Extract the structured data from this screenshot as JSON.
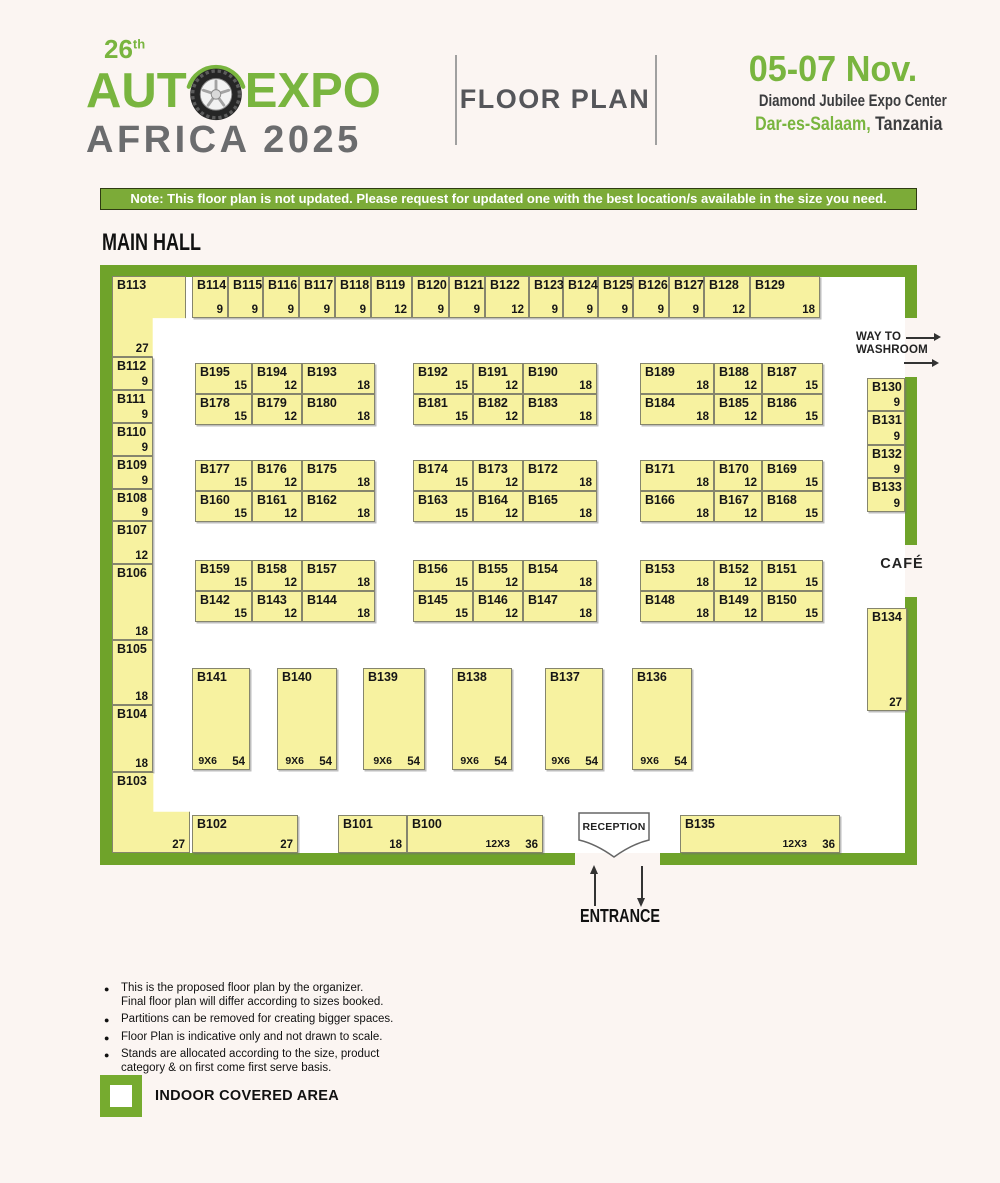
{
  "logo": {
    "edition": "26",
    "edition_sup": "th",
    "word1": "AUT",
    "word2": "EXPO",
    "line2": "AFRICA 2025"
  },
  "header": {
    "title": "FLOOR PLAN",
    "dates": "05-07 Nov.",
    "venue": "Diamond Jubilee Expo Center",
    "city": "Dar-es-Salaam,",
    "country": "Tanzania"
  },
  "note": "Note: This floor plan is not updated. Please request for updated one with the best location/s available in the size you need.",
  "hall_title": "MAIN HALL",
  "labels": {
    "way_to": "WAY TO",
    "washroom": "WASHROOM",
    "cafe": "CAFÉ",
    "reception": "RECEPTION",
    "entrance": "ENTRANCE"
  },
  "colors": {
    "brand_green": "#79b53f",
    "wall_green": "#6fa32a",
    "note_bar_green": "#7cab38",
    "booth_fill": "#f7f2a0",
    "title_gray": "#55565a"
  },
  "booths": [
    {
      "id": "B113",
      "size": "27",
      "x": 112,
      "y": 276,
      "w": 74,
      "h": 81,
      "shape": "corner-tl"
    },
    {
      "id": "B114",
      "size": "9",
      "x": 192,
      "y": 276,
      "w": 36,
      "h": 42
    },
    {
      "id": "B115",
      "size": "9",
      "x": 228,
      "y": 276,
      "w": 35,
      "h": 42
    },
    {
      "id": "B116",
      "size": "9",
      "x": 263,
      "y": 276,
      "w": 36,
      "h": 42
    },
    {
      "id": "B117",
      "size": "9",
      "x": 299,
      "y": 276,
      "w": 36,
      "h": 42
    },
    {
      "id": "B118",
      "size": "9",
      "x": 335,
      "y": 276,
      "w": 36,
      "h": 42
    },
    {
      "id": "B119",
      "size": "12",
      "x": 371,
      "y": 276,
      "w": 41,
      "h": 42
    },
    {
      "id": "B120",
      "size": "9",
      "x": 412,
      "y": 276,
      "w": 37,
      "h": 42
    },
    {
      "id": "B121",
      "size": "9",
      "x": 449,
      "y": 276,
      "w": 36,
      "h": 42
    },
    {
      "id": "B122",
      "size": "12",
      "x": 485,
      "y": 276,
      "w": 44,
      "h": 42
    },
    {
      "id": "B123",
      "size": "9",
      "x": 529,
      "y": 276,
      "w": 34,
      "h": 42
    },
    {
      "id": "B124",
      "size": "9",
      "x": 563,
      "y": 276,
      "w": 35,
      "h": 42
    },
    {
      "id": "B125",
      "size": "9",
      "x": 598,
      "y": 276,
      "w": 35,
      "h": 42
    },
    {
      "id": "B126",
      "size": "9",
      "x": 633,
      "y": 276,
      "w": 36,
      "h": 42
    },
    {
      "id": "B127",
      "size": "9",
      "x": 669,
      "y": 276,
      "w": 35,
      "h": 42
    },
    {
      "id": "B128",
      "size": "12",
      "x": 704,
      "y": 276,
      "w": 46,
      "h": 42
    },
    {
      "id": "B129",
      "size": "18",
      "x": 750,
      "y": 276,
      "w": 70,
      "h": 42
    },
    {
      "id": "B112",
      "size": "9",
      "x": 112,
      "y": 357,
      "w": 41,
      "h": 33
    },
    {
      "id": "B111",
      "size": "9",
      "x": 112,
      "y": 390,
      "w": 41,
      "h": 33
    },
    {
      "id": "B110",
      "size": "9",
      "x": 112,
      "y": 423,
      "w": 41,
      "h": 33
    },
    {
      "id": "B109",
      "size": "9",
      "x": 112,
      "y": 456,
      "w": 41,
      "h": 33
    },
    {
      "id": "B108",
      "size": "9",
      "x": 112,
      "y": 489,
      "w": 41,
      "h": 32
    },
    {
      "id": "B107",
      "size": "12",
      "x": 112,
      "y": 521,
      "w": 41,
      "h": 43
    },
    {
      "id": "B106",
      "size": "18",
      "x": 112,
      "y": 564,
      "w": 41,
      "h": 76
    },
    {
      "id": "B105",
      "size": "18",
      "x": 112,
      "y": 640,
      "w": 41,
      "h": 65
    },
    {
      "id": "B104",
      "size": "18",
      "x": 112,
      "y": 705,
      "w": 41,
      "h": 67
    },
    {
      "id": "B103",
      "size": "27",
      "x": 112,
      "y": 772,
      "w": 78,
      "h": 81,
      "shape": "corner-bl"
    },
    {
      "id": "B130",
      "size": "9",
      "x": 867,
      "y": 378,
      "w": 38,
      "h": 33
    },
    {
      "id": "B131",
      "size": "9",
      "x": 867,
      "y": 411,
      "w": 38,
      "h": 34
    },
    {
      "id": "B132",
      "size": "9",
      "x": 867,
      "y": 445,
      "w": 38,
      "h": 33
    },
    {
      "id": "B133",
      "size": "9",
      "x": 867,
      "y": 478,
      "w": 38,
      "h": 34
    },
    {
      "id": "B134",
      "size": "27",
      "x": 867,
      "y": 608,
      "w": 40,
      "h": 103
    },
    {
      "id": "B195",
      "size": "15",
      "x": 195,
      "y": 363,
      "w": 57,
      "h": 31
    },
    {
      "id": "B194",
      "size": "12",
      "x": 252,
      "y": 363,
      "w": 50,
      "h": 31
    },
    {
      "id": "B193",
      "size": "18",
      "x": 302,
      "y": 363,
      "w": 73,
      "h": 31
    },
    {
      "id": "B178",
      "size": "15",
      "x": 195,
      "y": 394,
      "w": 57,
      "h": 31
    },
    {
      "id": "B179",
      "size": "12",
      "x": 252,
      "y": 394,
      "w": 50,
      "h": 31
    },
    {
      "id": "B180",
      "size": "18",
      "x": 302,
      "y": 394,
      "w": 73,
      "h": 31
    },
    {
      "id": "B192",
      "size": "15",
      "x": 413,
      "y": 363,
      "w": 60,
      "h": 31
    },
    {
      "id": "B191",
      "size": "12",
      "x": 473,
      "y": 363,
      "w": 50,
      "h": 31
    },
    {
      "id": "B190",
      "size": "18",
      "x": 523,
      "y": 363,
      "w": 74,
      "h": 31
    },
    {
      "id": "B181",
      "size": "15",
      "x": 413,
      "y": 394,
      "w": 60,
      "h": 31
    },
    {
      "id": "B182",
      "size": "12",
      "x": 473,
      "y": 394,
      "w": 50,
      "h": 31
    },
    {
      "id": "B183",
      "size": "18",
      "x": 523,
      "y": 394,
      "w": 74,
      "h": 31
    },
    {
      "id": "B189",
      "size": "18",
      "x": 640,
      "y": 363,
      "w": 74,
      "h": 31
    },
    {
      "id": "B188",
      "size": "12",
      "x": 714,
      "y": 363,
      "w": 48,
      "h": 31
    },
    {
      "id": "B187",
      "size": "15",
      "x": 762,
      "y": 363,
      "w": 61,
      "h": 31
    },
    {
      "id": "B184",
      "size": "18",
      "x": 640,
      "y": 394,
      "w": 74,
      "h": 31
    },
    {
      "id": "B185",
      "size": "12",
      "x": 714,
      "y": 394,
      "w": 48,
      "h": 31
    },
    {
      "id": "B186",
      "size": "15",
      "x": 762,
      "y": 394,
      "w": 61,
      "h": 31
    },
    {
      "id": "B177",
      "size": "15",
      "x": 195,
      "y": 460,
      "w": 57,
      "h": 31
    },
    {
      "id": "B176",
      "size": "12",
      "x": 252,
      "y": 460,
      "w": 50,
      "h": 31
    },
    {
      "id": "B175",
      "size": "18",
      "x": 302,
      "y": 460,
      "w": 73,
      "h": 31
    },
    {
      "id": "B160",
      "size": "15",
      "x": 195,
      "y": 491,
      "w": 57,
      "h": 31
    },
    {
      "id": "B161",
      "size": "12",
      "x": 252,
      "y": 491,
      "w": 50,
      "h": 31
    },
    {
      "id": "B162",
      "size": "18",
      "x": 302,
      "y": 491,
      "w": 73,
      "h": 31
    },
    {
      "id": "B174",
      "size": "15",
      "x": 413,
      "y": 460,
      "w": 60,
      "h": 31
    },
    {
      "id": "B173",
      "size": "12",
      "x": 473,
      "y": 460,
      "w": 50,
      "h": 31
    },
    {
      "id": "B172",
      "size": "18",
      "x": 523,
      "y": 460,
      "w": 74,
      "h": 31
    },
    {
      "id": "B163",
      "size": "15",
      "x": 413,
      "y": 491,
      "w": 60,
      "h": 31
    },
    {
      "id": "B164",
      "size": "12",
      "x": 473,
      "y": 491,
      "w": 50,
      "h": 31
    },
    {
      "id": "B165",
      "size": "18",
      "x": 523,
      "y": 491,
      "w": 74,
      "h": 31
    },
    {
      "id": "B171",
      "size": "18",
      "x": 640,
      "y": 460,
      "w": 74,
      "h": 31
    },
    {
      "id": "B170",
      "size": "12",
      "x": 714,
      "y": 460,
      "w": 48,
      "h": 31
    },
    {
      "id": "B169",
      "size": "15",
      "x": 762,
      "y": 460,
      "w": 61,
      "h": 31
    },
    {
      "id": "B166",
      "size": "18",
      "x": 640,
      "y": 491,
      "w": 74,
      "h": 31
    },
    {
      "id": "B167",
      "size": "12",
      "x": 714,
      "y": 491,
      "w": 48,
      "h": 31
    },
    {
      "id": "B168",
      "size": "15",
      "x": 762,
      "y": 491,
      "w": 61,
      "h": 31
    },
    {
      "id": "B159",
      "size": "15",
      "x": 195,
      "y": 560,
      "w": 57,
      "h": 31
    },
    {
      "id": "B158",
      "size": "12",
      "x": 252,
      "y": 560,
      "w": 50,
      "h": 31
    },
    {
      "id": "B157",
      "size": "18",
      "x": 302,
      "y": 560,
      "w": 73,
      "h": 31
    },
    {
      "id": "B142",
      "size": "15",
      "x": 195,
      "y": 591,
      "w": 57,
      "h": 31
    },
    {
      "id": "B143",
      "size": "12",
      "x": 252,
      "y": 591,
      "w": 50,
      "h": 31
    },
    {
      "id": "B144",
      "size": "18",
      "x": 302,
      "y": 591,
      "w": 73,
      "h": 31
    },
    {
      "id": "B156",
      "size": "15",
      "x": 413,
      "y": 560,
      "w": 60,
      "h": 31
    },
    {
      "id": "B155",
      "size": "12",
      "x": 473,
      "y": 560,
      "w": 50,
      "h": 31
    },
    {
      "id": "B154",
      "size": "18",
      "x": 523,
      "y": 560,
      "w": 74,
      "h": 31
    },
    {
      "id": "B145",
      "size": "15",
      "x": 413,
      "y": 591,
      "w": 60,
      "h": 31
    },
    {
      "id": "B146",
      "size": "12",
      "x": 473,
      "y": 591,
      "w": 50,
      "h": 31
    },
    {
      "id": "B147",
      "size": "18",
      "x": 523,
      "y": 591,
      "w": 74,
      "h": 31
    },
    {
      "id": "B153",
      "size": "18",
      "x": 640,
      "y": 560,
      "w": 74,
      "h": 31
    },
    {
      "id": "B152",
      "size": "12",
      "x": 714,
      "y": 560,
      "w": 48,
      "h": 31
    },
    {
      "id": "B151",
      "size": "15",
      "x": 762,
      "y": 560,
      "w": 61,
      "h": 31
    },
    {
      "id": "B148",
      "size": "18",
      "x": 640,
      "y": 591,
      "w": 74,
      "h": 31
    },
    {
      "id": "B149",
      "size": "12",
      "x": 714,
      "y": 591,
      "w": 48,
      "h": 31
    },
    {
      "id": "B150",
      "size": "15",
      "x": 762,
      "y": 591,
      "w": 61,
      "h": 31
    },
    {
      "id": "B141",
      "dim": "9X6",
      "size": "54",
      "x": 192,
      "y": 668,
      "w": 58,
      "h": 102
    },
    {
      "id": "B140",
      "dim": "9X6",
      "size": "54",
      "x": 277,
      "y": 668,
      "w": 60,
      "h": 102
    },
    {
      "id": "B139",
      "dim": "9X6",
      "size": "54",
      "x": 363,
      "y": 668,
      "w": 62,
      "h": 102
    },
    {
      "id": "B138",
      "dim": "9X6",
      "size": "54",
      "x": 452,
      "y": 668,
      "w": 60,
      "h": 102
    },
    {
      "id": "B137",
      "dim": "9X6",
      "size": "54",
      "x": 545,
      "y": 668,
      "w": 58,
      "h": 102
    },
    {
      "id": "B136",
      "dim": "9X6",
      "size": "54",
      "x": 632,
      "y": 668,
      "w": 60,
      "h": 102
    },
    {
      "id": "B102",
      "size": "27",
      "x": 192,
      "y": 815,
      "w": 106,
      "h": 38
    },
    {
      "id": "B101",
      "size": "18",
      "x": 338,
      "y": 815,
      "w": 69,
      "h": 38
    },
    {
      "id": "B100",
      "dim": "12X3",
      "size": "36",
      "x": 407,
      "y": 815,
      "w": 136,
      "h": 38
    },
    {
      "id": "B135",
      "dim": "12X3",
      "size": "36",
      "x": 680,
      "y": 815,
      "w": 160,
      "h": 38
    }
  ],
  "footer_notes": [
    [
      "This is the proposed floor plan by the organizer.",
      "Final floor plan will differ according to sizes booked."
    ],
    [
      "Partitions can be removed for creating bigger spaces."
    ],
    [
      "Floor Plan is indicative only and not drawn to scale."
    ],
    [
      "Stands are allocated according to the size, product",
      "category & on first come first serve basis."
    ]
  ],
  "legend": "INDOOR COVERED AREA"
}
